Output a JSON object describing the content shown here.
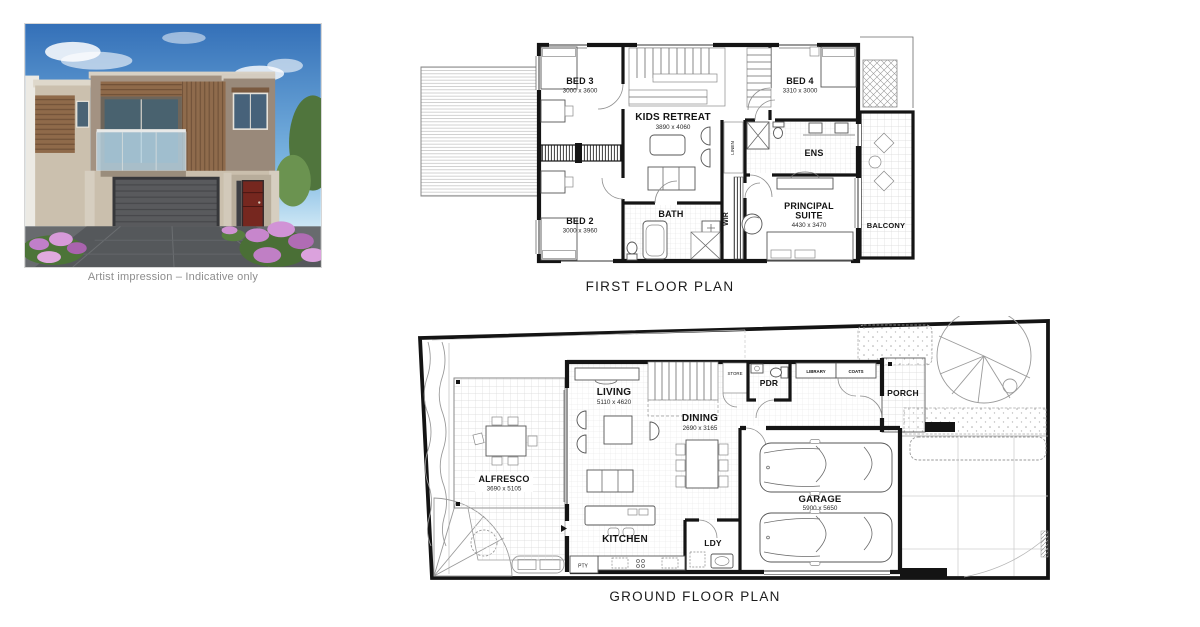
{
  "artist_impression": {
    "caption": "Artist impression – Indicative only",
    "colors": {
      "sky": "#3470b8",
      "upper_wall": "#a39282",
      "timber": "#8f6b4c",
      "lower_wall": "#cabfad",
      "garage_door": "#595a5d",
      "front_door": "#76271f",
      "driveway": "#55585b",
      "flowers": "#c786cc",
      "foliage": "#4c7438"
    }
  },
  "plan_colors": {
    "walls": "#141414",
    "thin_lines": "#6a6a6a",
    "tiles": "#d9d9d9"
  },
  "first_floor": {
    "title": "FIRST FLOOR PLAN",
    "rooms": {
      "bed3": {
        "name": "BED 3",
        "dims": "3000 x 3600"
      },
      "kids_retreat": {
        "name": "KIDS RETREAT",
        "dims": "3890 x 4060"
      },
      "bed4": {
        "name": "BED 4",
        "dims": "3310 x 3000"
      },
      "bed2": {
        "name": "BED 2",
        "dims": "3000 x 3960"
      },
      "bath": {
        "name": "BATH"
      },
      "wir": {
        "name": "WIR"
      },
      "linen": {
        "name": "LINEN"
      },
      "ens": {
        "name": "ENS"
      },
      "principal": {
        "line1": "PRINCIPAL",
        "line2": "SUITE",
        "dims": "4430 x 3470"
      },
      "balcony": {
        "name": "BALCONY"
      }
    }
  },
  "ground_floor": {
    "title": "GROUND FLOOR PLAN",
    "rooms": {
      "alfresco": {
        "name": "ALFRESCO",
        "dims": "3690 x 5105"
      },
      "living": {
        "name": "LIVING",
        "dims": "5110 x 4620"
      },
      "dining": {
        "name": "DINING",
        "dims": "2690 x 3165"
      },
      "kitchen": {
        "name": "KITCHEN"
      },
      "ldy": {
        "name": "LDY"
      },
      "pty": {
        "name": "PTY"
      },
      "pdr": {
        "name": "PDR"
      },
      "store": {
        "name": "STORE"
      },
      "library": {
        "name": "LIBRARY"
      },
      "coats": {
        "name": "COATS"
      },
      "porch": {
        "name": "PORCH"
      },
      "garage": {
        "name": "GARAGE",
        "dims": "5900 x 5650"
      }
    }
  }
}
